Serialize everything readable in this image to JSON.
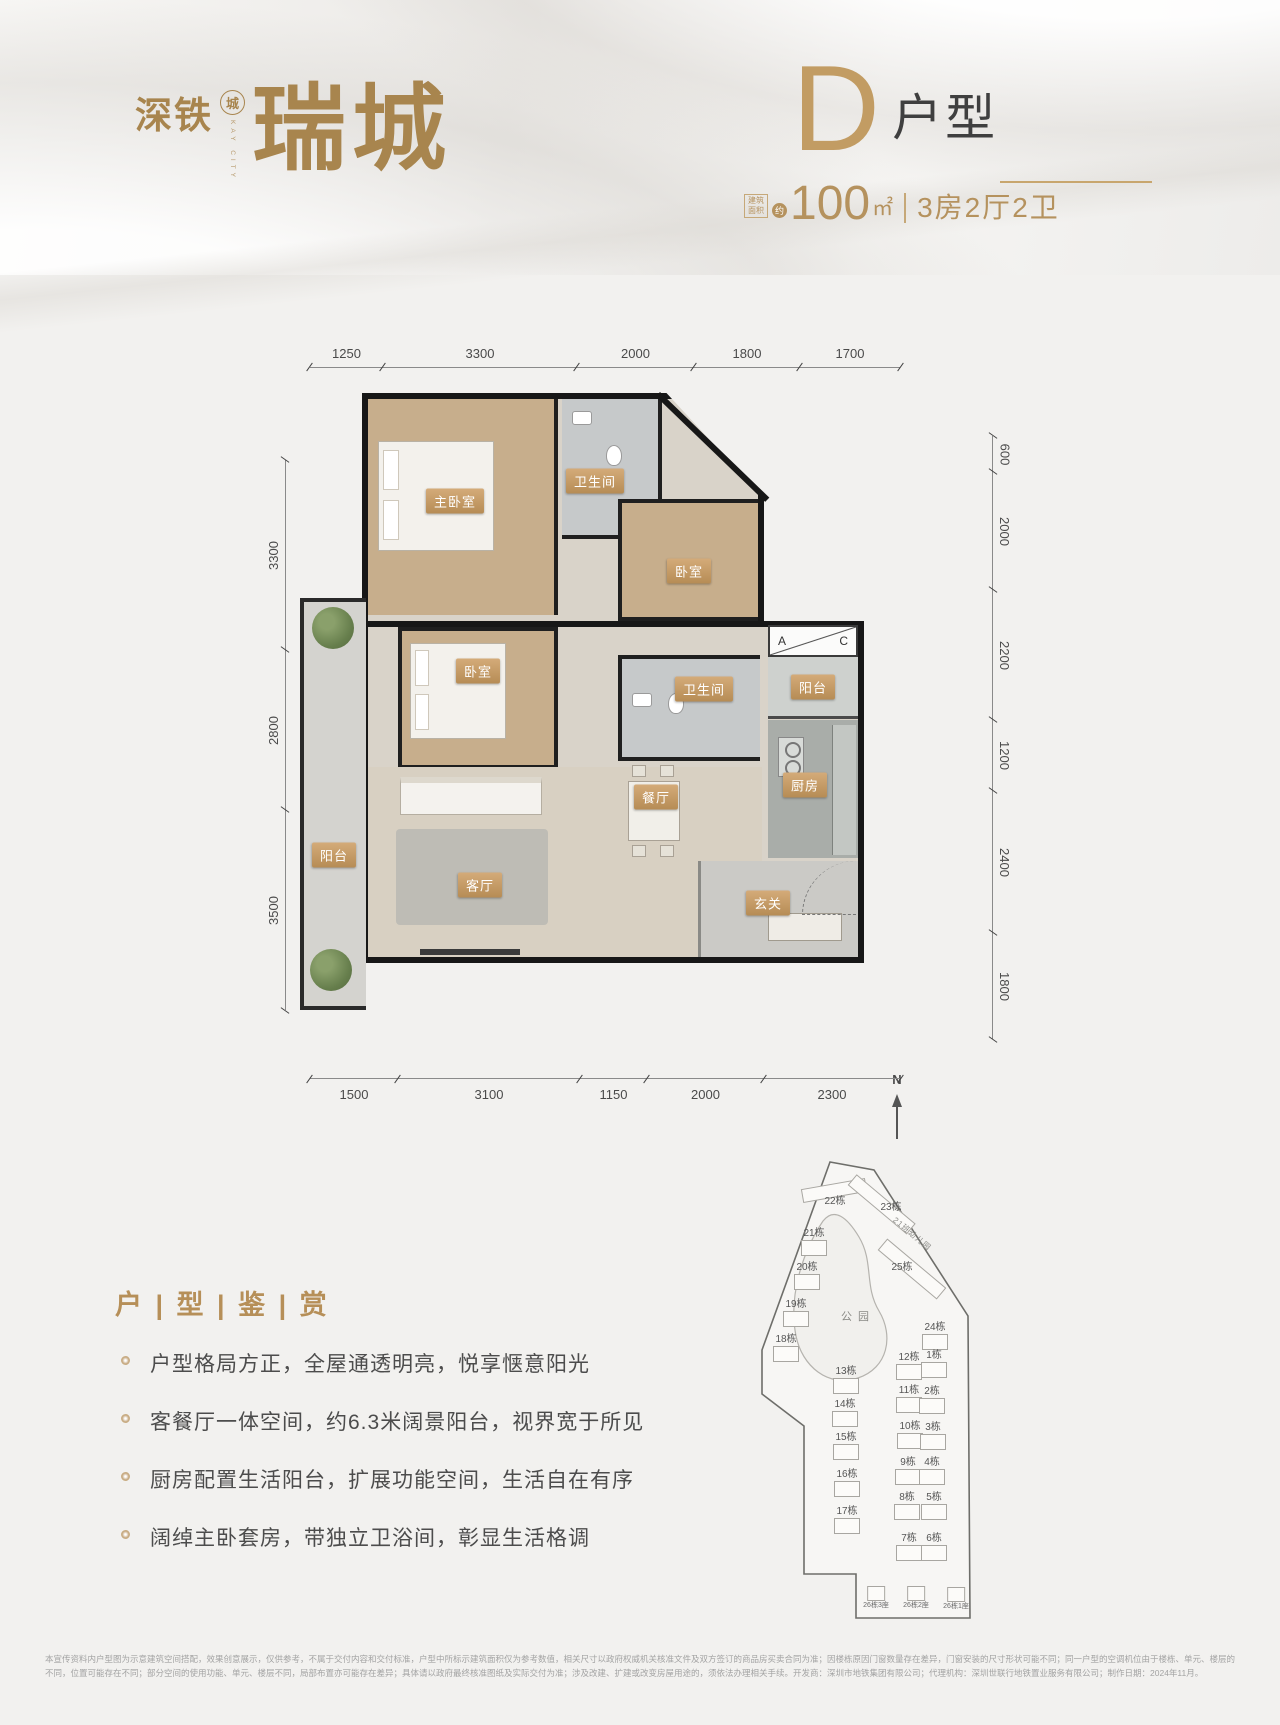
{
  "header": {
    "brand": {
      "line1": "深铁",
      "seal": "城",
      "seal_sub": "KAY CITY",
      "main": "瑞城"
    },
    "unit": {
      "letter": "D",
      "suffix": "户型",
      "area_prefix_line1": "建筑",
      "area_prefix_line2": "面积",
      "area_approx": "约",
      "area_value": "100",
      "area_unit": "㎡",
      "spec": "3房2厅2卫"
    }
  },
  "floorplan": {
    "dims_top": [
      "1250",
      "3300",
      "2000",
      "1800",
      "1700"
    ],
    "dims_left": [
      "3300",
      "2800",
      "3500"
    ],
    "dims_right": [
      "600",
      "2000",
      "2200",
      "1200",
      "2400",
      "1800"
    ],
    "dims_bottom": [
      "1500",
      "3100",
      "1150",
      "2000",
      "2300"
    ],
    "ac_a": "A",
    "ac_c": "C",
    "labels": [
      {
        "label": "主卧室",
        "x": 155,
        "y": 108
      },
      {
        "label": "卫生间",
        "x": 295,
        "y": 88
      },
      {
        "label": "卧室",
        "x": 389,
        "y": 178
      },
      {
        "label": "卧室",
        "x": 178,
        "y": 278
      },
      {
        "label": "卫生间",
        "x": 404,
        "y": 296
      },
      {
        "label": "阳台",
        "x": 513,
        "y": 294
      },
      {
        "label": "厨房",
        "x": 505,
        "y": 392
      },
      {
        "label": "餐厅",
        "x": 356,
        "y": 404
      },
      {
        "label": "客厅",
        "x": 180,
        "y": 492
      },
      {
        "label": "玄关",
        "x": 468,
        "y": 510
      },
      {
        "label": "阳台",
        "x": 34,
        "y": 462
      }
    ]
  },
  "features": {
    "title": "户 | 型 | 鉴 | 赏",
    "items": [
      "户型格局方正，全屋通透明亮，悦享惬意阳光",
      "客餐厅一体空间，约6.3米阔景阳台，视界宽于所见",
      "厨房配置生活阳台，扩展功能空间，生活自在有序",
      "阔绰主卧套房，带独立卫浴间，彰显生活格调"
    ]
  },
  "sitemap": {
    "north": "N",
    "park": "公园",
    "kindergarten": "21班幼儿园",
    "buildings": [
      {
        "label": "22栋",
        "x": 147,
        "y": 130,
        "cls": "noicon"
      },
      {
        "label": "23栋",
        "x": 203,
        "y": 136,
        "cls": "noicon"
      },
      {
        "label": "21栋",
        "x": 126,
        "y": 162
      },
      {
        "label": "20栋",
        "x": 119,
        "y": 196
      },
      {
        "label": "25栋",
        "x": 214,
        "y": 196,
        "cls": "noicon"
      },
      {
        "label": "19栋",
        "x": 108,
        "y": 233
      },
      {
        "label": "18栋",
        "x": 98,
        "y": 268
      },
      {
        "label": "24栋",
        "x": 247,
        "y": 256
      },
      {
        "label": "12栋",
        "x": 221,
        "y": 286
      },
      {
        "label": "1栋",
        "x": 246,
        "y": 284
      },
      {
        "label": "13栋",
        "x": 158,
        "y": 300
      },
      {
        "label": "11栋",
        "x": 221,
        "y": 319
      },
      {
        "label": "2栋",
        "x": 244,
        "y": 320
      },
      {
        "label": "14栋",
        "x": 157,
        "y": 333
      },
      {
        "label": "10栋",
        "x": 222,
        "y": 355
      },
      {
        "label": "3栋",
        "x": 245,
        "y": 356
      },
      {
        "label": "15栋",
        "x": 158,
        "y": 366
      },
      {
        "label": "9栋",
        "x": 220,
        "y": 391
      },
      {
        "label": "4栋",
        "x": 244,
        "y": 391
      },
      {
        "label": "16栋",
        "x": 159,
        "y": 403
      },
      {
        "label": "8栋",
        "x": 219,
        "y": 426
      },
      {
        "label": "5栋",
        "x": 246,
        "y": 426
      },
      {
        "label": "17栋",
        "x": 159,
        "y": 440
      },
      {
        "label": "7栋",
        "x": 221,
        "y": 467
      },
      {
        "label": "6栋",
        "x": 246,
        "y": 467
      },
      {
        "label": "26栋3座",
        "x": 188,
        "y": 520,
        "cls": "tiny"
      },
      {
        "label": "26栋2座",
        "x": 228,
        "y": 520,
        "cls": "tiny"
      },
      {
        "label": "26栋1座",
        "x": 268,
        "y": 521,
        "cls": "tiny"
      }
    ]
  },
  "disclaimer": "本宣传资料内户型图为示意建筑空间搭配，效果创意展示，仅供参考，不属于交付内容和交付标准，户型中所标示建筑面积仅为参考数值，相关尺寸以政府权威机关核准文件及双方签订的商品房买卖合同为准；因楼栋原因门窗数量存在差异，门窗安装的尺寸形状可能不同；同一户型的空调机位由于楼栋、单元、楼层的不同，位置可能存在不同；部分空间的使用功能、单元、楼层不同，局部布置亦可能存在差异；具体请以政府最终核准图纸及实际交付为准；涉及改建、扩建或改变房屋用途的，须依法办理相关手续。开发商：深圳市地铁集团有限公司；代理机构：深圳世联行地铁置业服务有限公司；制作日期：2024年11月。"
}
